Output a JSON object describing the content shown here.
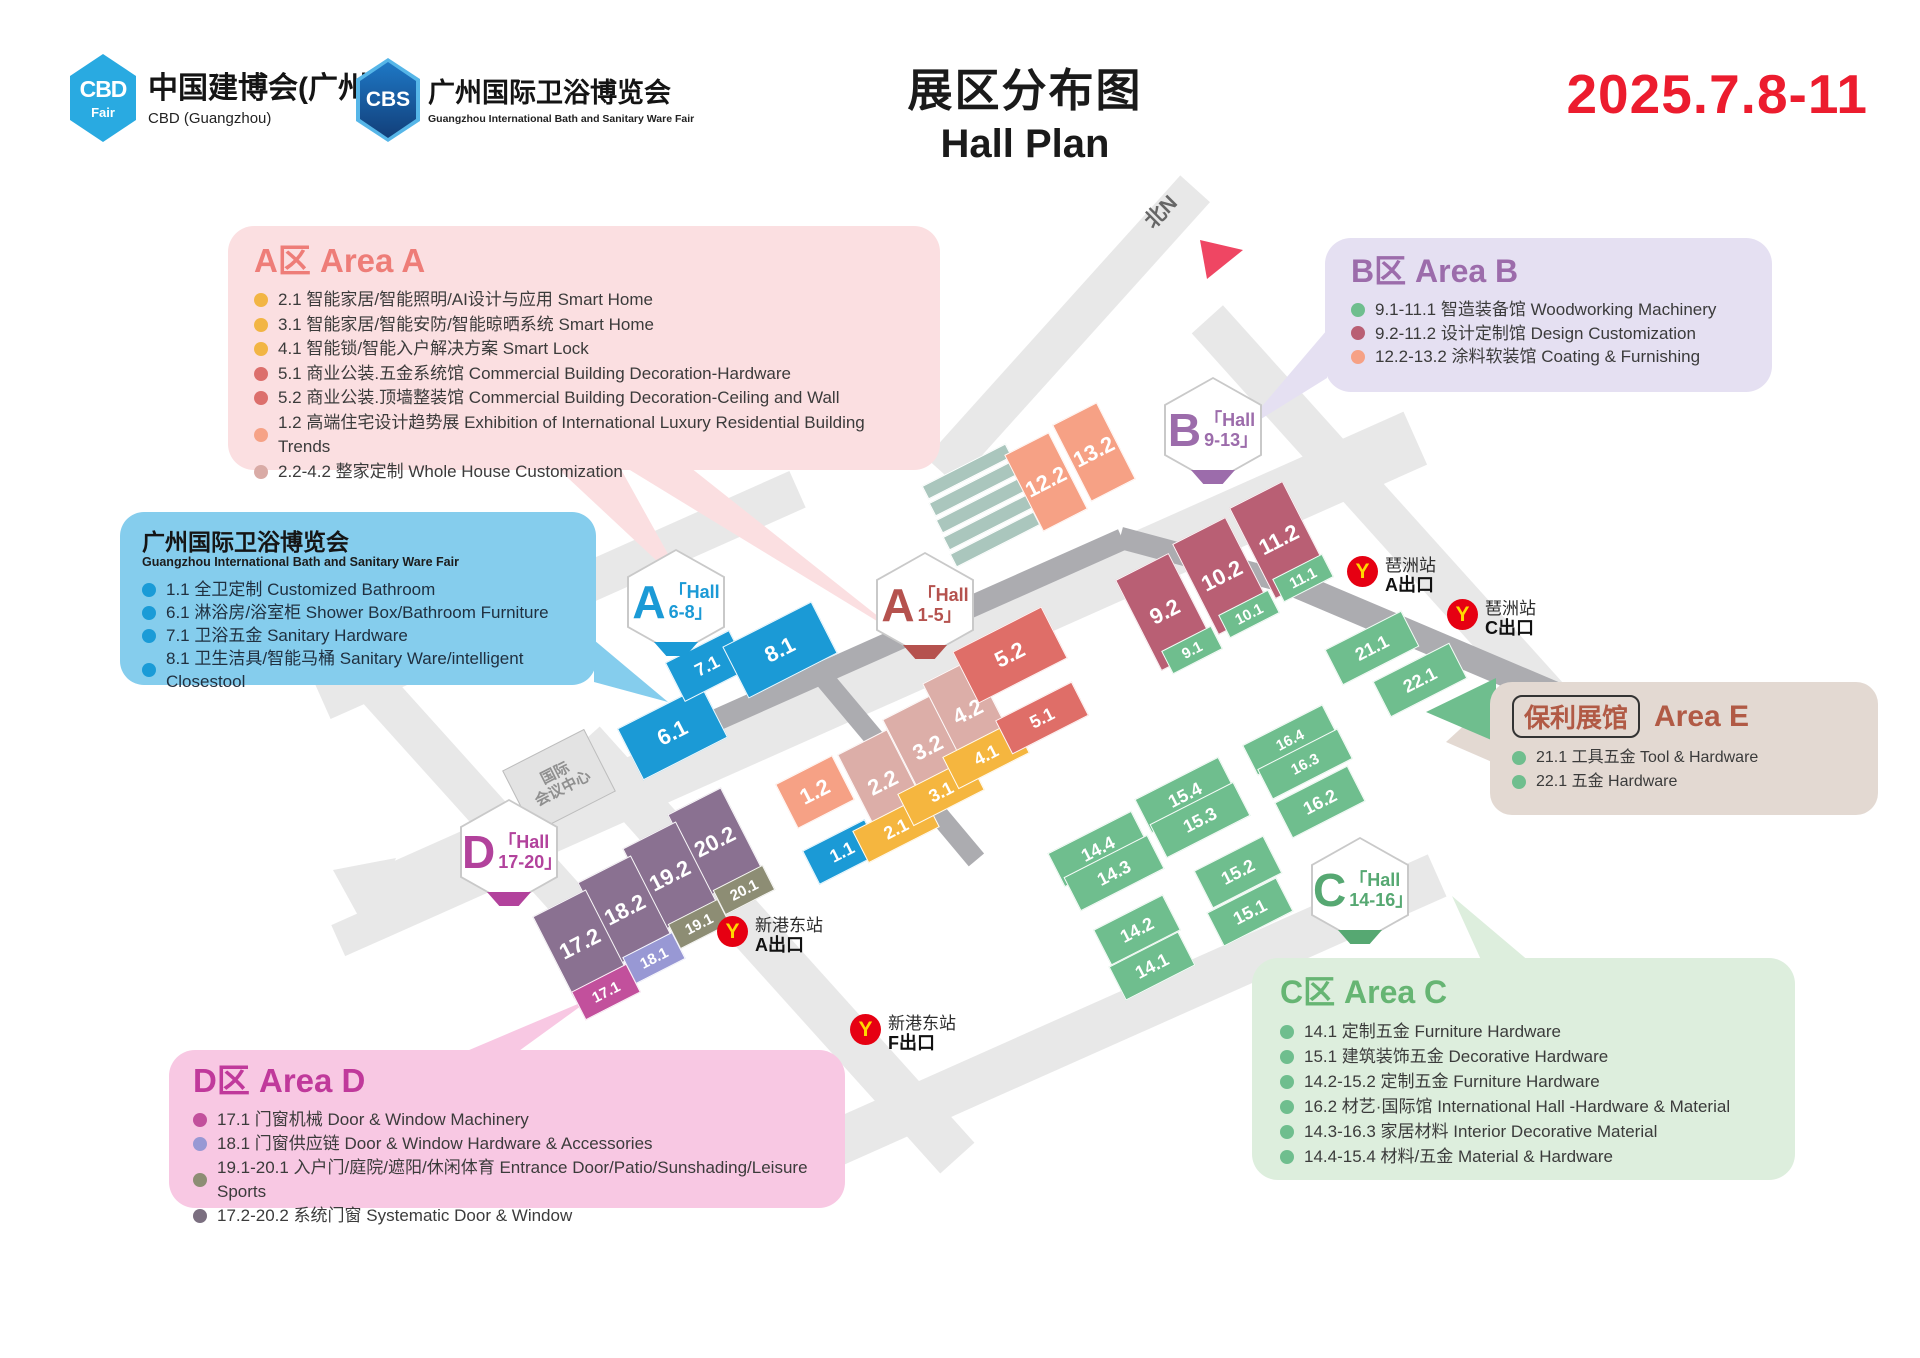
{
  "header": {
    "cbd_logo": {
      "badge": "CBD",
      "badge_sub": "Fair",
      "title": "中国建博会(广州)",
      "subtitle": "CBD (Guangzhou)"
    },
    "cbs_logo": {
      "badge": "CBS",
      "title": "广州国际卫浴博览会",
      "subtitle": "Guangzhou International Bath and Sanitary Ware Fair"
    },
    "title_zh": "展区分布图",
    "title_en": "Hall Plan",
    "date": "2025.7.8-11"
  },
  "legend": {
    "areaA": {
      "title": "A区 Area A",
      "accent": "#ee7d78",
      "items": [
        {
          "dot": "#f2b544",
          "text": "2.1 智能家居/智能照明/AI设计与应用 Smart Home"
        },
        {
          "dot": "#f2b544",
          "text": "3.1 智能家居/智能安防/智能晾晒系统 Smart Home"
        },
        {
          "dot": "#f2b544",
          "text": "4.1 智能锁/智能入户解决方案 Smart Lock"
        },
        {
          "dot": "#dc6f6c",
          "text": "5.1 商业公装.五金系统馆 Commercial Building Decoration-Hardware"
        },
        {
          "dot": "#dc6f6c",
          "text": "5.2 商业公装.顶墙整装馆 Commercial Building Decoration-Ceiling and Wall"
        },
        {
          "dot": "#f6a286",
          "text": "1.2 高端住宅设计趋势展 Exhibition of International Luxury Residential Building Trends"
        },
        {
          "dot": "#d9aba6",
          "text": "2.2-4.2 整家定制 Whole House Customization"
        }
      ]
    },
    "bath": {
      "title": "广州国际卫浴博览会",
      "subtitle": "Guangzhou International Bath and Sanitary Ware Fair",
      "items": [
        {
          "dot": "#1a9bd7",
          "text": "1.1 全卫定制 Customized Bathroom"
        },
        {
          "dot": "#1a9bd7",
          "text": "6.1 淋浴房/浴室柜 Shower Box/Bathroom Furniture"
        },
        {
          "dot": "#1a9bd7",
          "text": "7.1 卫浴五金 Sanitary Hardware"
        },
        {
          "dot": "#1a9bd7",
          "text": "8.1 卫生洁具/智能马桶 Sanitary Ware/intelligent Closestool"
        }
      ]
    },
    "areaB": {
      "title": "B区 Area B",
      "accent": "#9c6cab",
      "items": [
        {
          "dot": "#6fbe8e",
          "text": "9.1-11.1 智造装备馆 Woodworking Machinery"
        },
        {
          "dot": "#b95f74",
          "text": "9.2-11.2 设计定制馆 Design Customization"
        },
        {
          "dot": "#f6a185",
          "text": "12.2-13.2 涂料软装馆 Coating & Furnishing"
        }
      ]
    },
    "areaE": {
      "badge": "保利展馆",
      "title": "Area E",
      "accent": "#b15a45",
      "items": [
        {
          "dot": "#6fbe8e",
          "text": "21.1 工具五金 Tool & Hardware"
        },
        {
          "dot": "#6fbe8e",
          "text": "22.1 五金 Hardware"
        }
      ]
    },
    "areaC": {
      "title": "C区 Area C",
      "accent": "#66b573",
      "items": [
        {
          "dot": "#6fbe8e",
          "text": "14.1 定制五金 Furniture Hardware"
        },
        {
          "dot": "#6fbe8e",
          "text": "15.1 建筑装饰五金 Decorative Hardware"
        },
        {
          "dot": "#6fbe8e",
          "text": "14.2-15.2 定制五金 Furniture Hardware"
        },
        {
          "dot": "#6fbe8e",
          "text": "16.2 材艺·国际馆 International Hall -Hardware & Material"
        },
        {
          "dot": "#6fbe8e",
          "text": "14.3-16.3 家居材料 Interior Decorative Material"
        },
        {
          "dot": "#6fbe8e",
          "text": "14.4-15.4 材料/五金 Material & Hardware"
        }
      ]
    },
    "areaD": {
      "title": "D区 Area D",
      "accent": "#c0399b",
      "items": [
        {
          "dot": "#c2509c",
          "text": "17.1 门窗机械  Door & Window Machinery"
        },
        {
          "dot": "#9898d4",
          "text": "18.1 门窗供应链  Door & Window Hardware & Accessories"
        },
        {
          "dot": "#8d8d74",
          "text": "19.1-20.1 入户门/庭院/遮阳/休闲体育 Entrance Door/Patio/Sunshading/Leisure Sports"
        },
        {
          "dot": "#7b6f80",
          "text": "17.2-20.2 系统门窗 Systematic Door & Window"
        }
      ]
    }
  },
  "map": {
    "north_label": "北N",
    "convention_center": [
      "国际",
      "会议中心"
    ],
    "palette": {
      "blue": "#1b9ad6",
      "yellow": "#f5b63f",
      "dusty": "#dcaea8",
      "salmon": "#f6a185",
      "red": "#df6e68",
      "rose": "#b95f74",
      "green": "#6fbe8e",
      "purple": "#8a7191",
      "olive": "#8d8d74",
      "peri": "#9898d4",
      "magenta": "#c2509c"
    },
    "hexagons": [
      {
        "letter": "A",
        "line1": "「Hall",
        "line2": "6-8」",
        "color": "#1b9ad6"
      },
      {
        "letter": "A",
        "line1": "「Hall",
        "line2": "1-5」",
        "color": "#b5524e"
      },
      {
        "letter": "B",
        "line1": "「Hall",
        "line2": "9-13」",
        "color": "#9c6cab"
      },
      {
        "letter": "C",
        "line1": "「Hall",
        "line2": "14-16」",
        "color": "#56a872"
      },
      {
        "letter": "D",
        "line1": "「Hall",
        "line2": "17-20」",
        "color": "#b2429c"
      }
    ],
    "blocks": [
      {
        "label": "6.1",
        "color": "blue"
      },
      {
        "label": "7.1",
        "color": "blue"
      },
      {
        "label": "8.1",
        "color": "blue"
      },
      {
        "label": "1.1",
        "color": "blue"
      },
      {
        "label": "1.2",
        "color": "salmon"
      },
      {
        "label": "2.2",
        "color": "dusty"
      },
      {
        "label": "3.2",
        "color": "dusty"
      },
      {
        "label": "4.2",
        "color": "dusty"
      },
      {
        "label": "2.1",
        "color": "yellow"
      },
      {
        "label": "3.1",
        "color": "yellow"
      },
      {
        "label": "4.1",
        "color": "yellow"
      },
      {
        "label": "5.2",
        "color": "red"
      },
      {
        "label": "5.1",
        "color": "red"
      },
      {
        "label": "12.2",
        "color": "salmon"
      },
      {
        "label": "13.2",
        "color": "salmon"
      },
      {
        "label": "9.2",
        "color": "rose"
      },
      {
        "label": "10.2",
        "color": "rose"
      },
      {
        "label": "11.2",
        "color": "rose"
      },
      {
        "label": "9.1",
        "color": "green"
      },
      {
        "label": "10.1",
        "color": "green"
      },
      {
        "label": "11.1",
        "color": "green"
      },
      {
        "label": "21.1",
        "color": "green"
      },
      {
        "label": "22.1",
        "color": "green"
      },
      {
        "label": "16.4",
        "color": "green"
      },
      {
        "label": "16.3",
        "color": "green"
      },
      {
        "label": "16.2",
        "color": "green"
      },
      {
        "label": "15.4",
        "color": "green"
      },
      {
        "label": "15.3",
        "color": "green"
      },
      {
        "label": "15.2",
        "color": "green"
      },
      {
        "label": "15.1",
        "color": "green"
      },
      {
        "label": "14.4",
        "color": "green"
      },
      {
        "label": "14.3",
        "color": "green"
      },
      {
        "label": "14.2",
        "color": "green"
      },
      {
        "label": "14.1",
        "color": "green"
      },
      {
        "label": "20.2",
        "color": "purple"
      },
      {
        "label": "19.2",
        "color": "purple"
      },
      {
        "label": "18.2",
        "color": "purple"
      },
      {
        "label": "17.2",
        "color": "purple"
      },
      {
        "label": "20.1",
        "color": "olive"
      },
      {
        "label": "19.1",
        "color": "olive"
      },
      {
        "label": "18.1",
        "color": "peri"
      },
      {
        "label": "17.1",
        "color": "magenta"
      }
    ],
    "metro": [
      {
        "station": "琶洲站",
        "exit": "A出口"
      },
      {
        "station": "琶洲站",
        "exit": "C出口"
      },
      {
        "station": "新港东站",
        "exit": "A出口"
      },
      {
        "station": "新港东站",
        "exit": "F出口"
      }
    ]
  }
}
